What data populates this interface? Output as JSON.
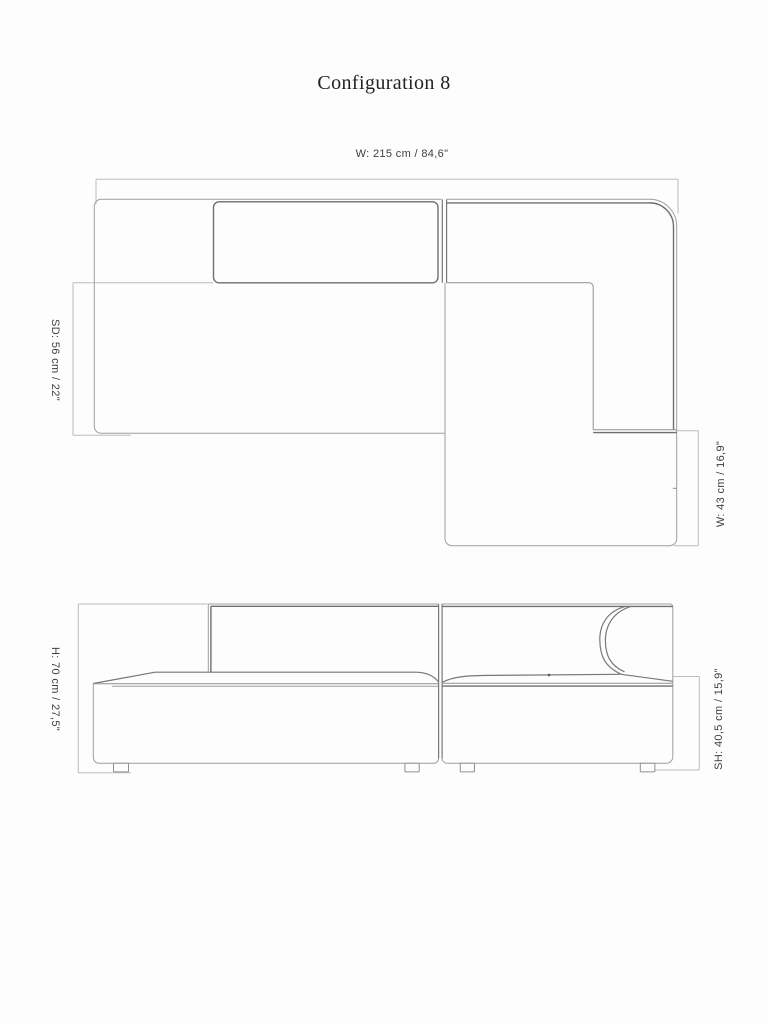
{
  "page": {
    "title": "Configuration 8"
  },
  "plan_view": {
    "width_label": "W: 215 cm / 84,6\"",
    "seat_depth_label": "SD: 56 cm / 22\"",
    "chaise_width_label": "W: 43 cm / 16,9\""
  },
  "front_view": {
    "height_label": "H: 70 cm / 27,5\"",
    "seat_height_label": "SH: 40,5 cm / 15,9\""
  },
  "colors": {
    "background": "#fdfdfd",
    "outline_thin": "#9e9e9e",
    "outline_heavy": "#6f6f6f",
    "dimension_line": "#bcbcbc",
    "label_text": "#3f3f3f",
    "title_text": "#222222"
  }
}
